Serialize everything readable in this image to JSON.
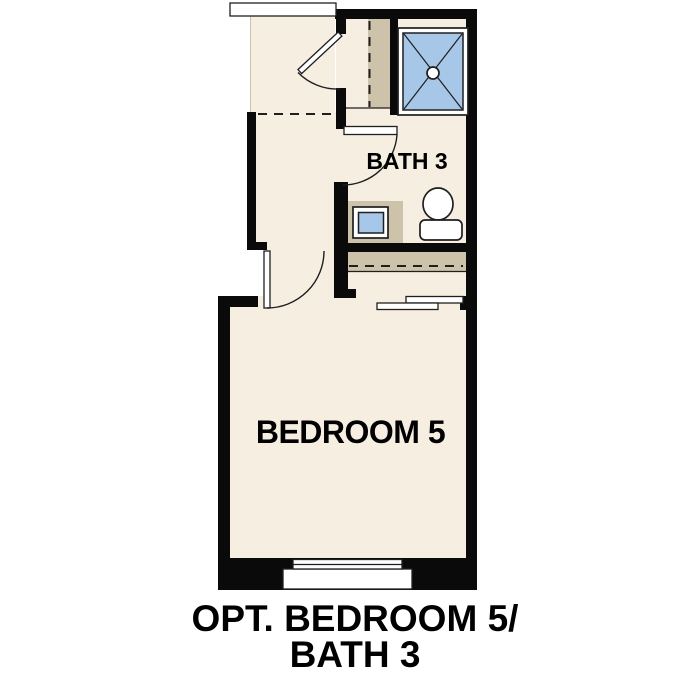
{
  "colors": {
    "wall": "#0a0a0a",
    "floor": "#f6eee0",
    "shelf_tan": "#cdc2aa",
    "fixture_blue": "#a7c7e8",
    "line": "#1f1f1f",
    "background": "#ffffff",
    "text": "#000000"
  },
  "labels": {
    "bath": "BATH 3",
    "bedroom": "BEDROOM 5"
  },
  "caption": {
    "line1": "OPT. BEDROOM 5/",
    "line2": "BATH 3"
  }
}
